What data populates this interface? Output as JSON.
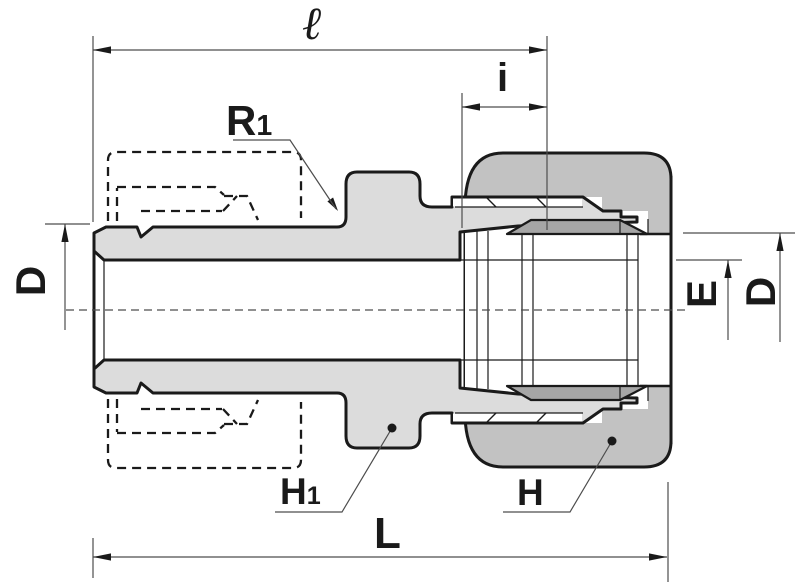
{
  "drawing": {
    "kind": "cross-section technical drawing of a compression tube fitting (male connector body with nut and ferrules)",
    "labels": {
      "ell": "ℓ",
      "i": "i",
      "r1": {
        "main": "R",
        "sub": "1"
      },
      "d_left": "D",
      "e_right": "E",
      "d_right": "D",
      "h1": {
        "main": "H",
        "sub": "1"
      },
      "h": "H",
      "l": "L"
    },
    "colors": {
      "background": "#ffffff",
      "body_fill": "#dcdcdc",
      "nut_fill": "#c2c2c2",
      "ferrule_fill": "#a6a6a6",
      "line": "#1a1a1a",
      "dim_line": "#4d4d4d",
      "label": "#1a1a1a"
    }
  }
}
